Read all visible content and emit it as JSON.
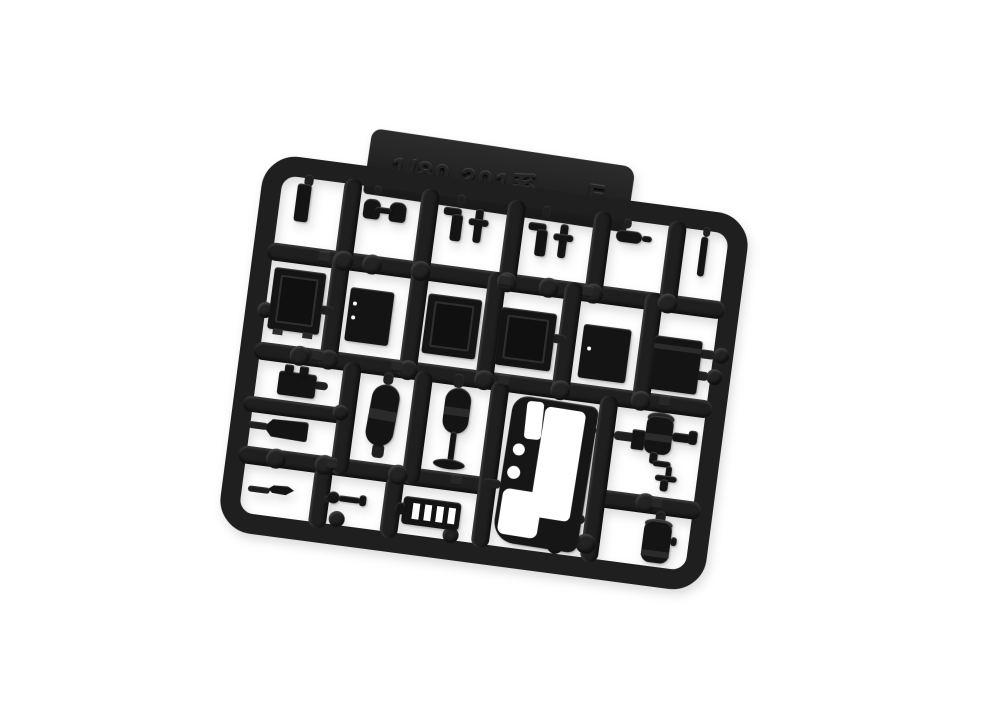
{
  "scene": {
    "subject": "Injection-molded plastic model parts runner (sprue), black plastic photographed on a white background",
    "kit_scale": "1/80",
    "series": "201系",
    "runner_id": "E",
    "background_color": "#ffffff",
    "plastic_color": "#1f1f1f",
    "highlight_color": "#3d3d3d"
  },
  "tab": {
    "scale_text": "1/80 201系",
    "runner_letter": "E"
  },
  "parts": {
    "row1": [
      "flat bar",
      "paired knobs",
      "bracket and tee pair",
      "bracket and tee pair",
      "pipe fitting",
      "thin rod"
    ],
    "row2": [
      "equipment box with lid",
      "vented equipment box",
      "paneled equipment box",
      "paneled equipment box",
      "plain equipment box",
      "lidded equipment box"
    ],
    "row3": [
      "battery box",
      "tapered box",
      "air tank cylinder",
      "reservoir with drain pipe",
      "cab front panel with windows",
      "compressor unit",
      "small tank"
    ],
    "row4": [
      "sliver part",
      "key shaped lever",
      "resistor grid box"
    ]
  }
}
